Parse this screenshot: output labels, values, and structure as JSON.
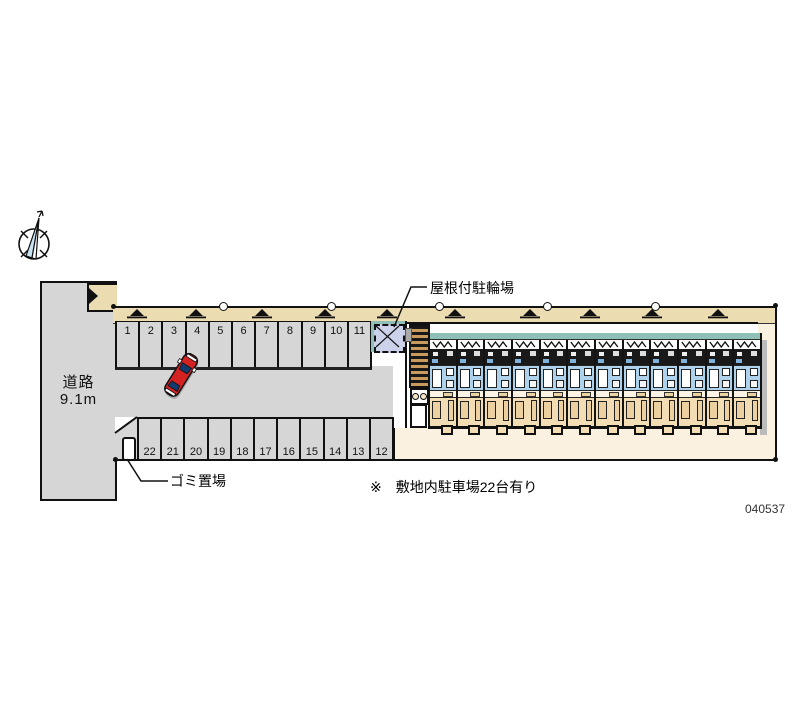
{
  "road": {
    "name": "道路",
    "width": "9.1m"
  },
  "parking": {
    "top_row": [
      "1",
      "2",
      "3",
      "4",
      "5",
      "6",
      "7",
      "8",
      "9",
      "10",
      "11"
    ],
    "bottom_row": [
      "22",
      "21",
      "20",
      "19",
      "18",
      "17",
      "16",
      "15",
      "14",
      "13",
      "12"
    ],
    "note": "※　敷地内駐車場22台有り",
    "total_stalls": 22
  },
  "labels": {
    "bicycle_shelter": "屋根付駐輪場",
    "garbage_area": "ゴミ置場",
    "plan_number": "040537"
  },
  "building": {
    "unit_count": 12
  },
  "icons": {
    "compass": "north-arrow-icon",
    "landscaping": "tree-symbol-icon",
    "boundary": "survey-marker-icon",
    "vehicle": "red-car-top-view"
  },
  "colors": {
    "asphalt": "#d6d6d6",
    "landscaping_tan": "#ecdcb2",
    "yard_cream": "#fbf1e0",
    "balcony_teal": "#8fbfb7",
    "unit_blue": "#aed2ec",
    "unit_tan": "#f3ddb5",
    "car_red": "#d42222"
  }
}
